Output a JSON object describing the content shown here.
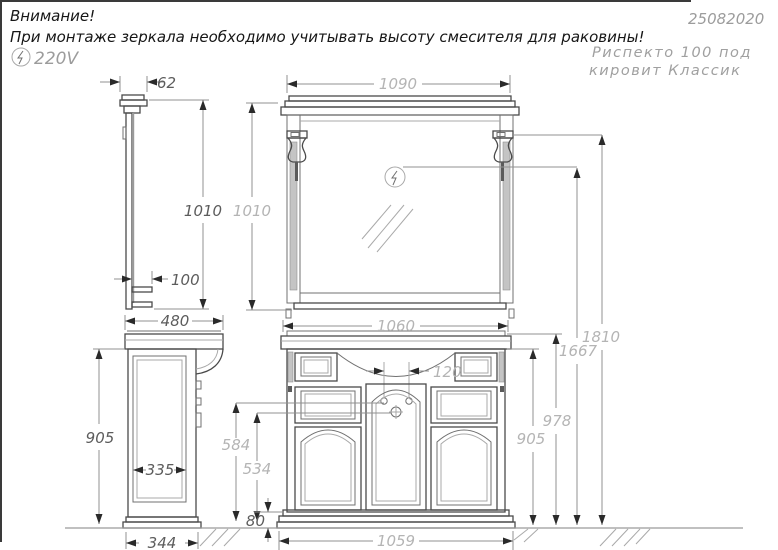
{
  "header": {
    "warning_title": "Внимание!",
    "warning_line": "При монтаже зеркала необходимо учитывать высоту смесителя для раковины!",
    "voltage_label": "220V",
    "doc_number": "25082020",
    "product_name_line1": "Риспекто 100 под",
    "product_name_line2": "кировит Классик"
  },
  "dims": {
    "mirror_cornice_depth": "62",
    "mirror_height_side": "1010",
    "mirror_height_front": "1010",
    "mirror_shelf_depth": "100",
    "mirror_width": "1090",
    "worktop_width": "1060",
    "cabinet_depth": "480",
    "cabinet_height_side": "905",
    "cabinet_height_front": "905",
    "worktop_height": "978",
    "side_panel_width": "335",
    "plinth_depth": "344",
    "faucet_holes_spacing": "120",
    "faucet_height": "584",
    "drain_height": "534",
    "plinth_height": "80",
    "plinth_width": "1059",
    "lamp_top_height": "1810",
    "lamp_center_height": "1667"
  },
  "icons": {
    "voltage_icon": "lightning-in-circle",
    "mirror_power_icon": "lightning-in-circle"
  },
  "colors": {
    "background": "#ffffff",
    "line_dark": "#4a4a4a",
    "line_light": "#a9a9a9",
    "dim_line": "#909090",
    "label_dark": "#5c5c5c",
    "label_light": "#b4b4b4",
    "note_text": "#161616",
    "gray_text": "#9c9c9c"
  }
}
